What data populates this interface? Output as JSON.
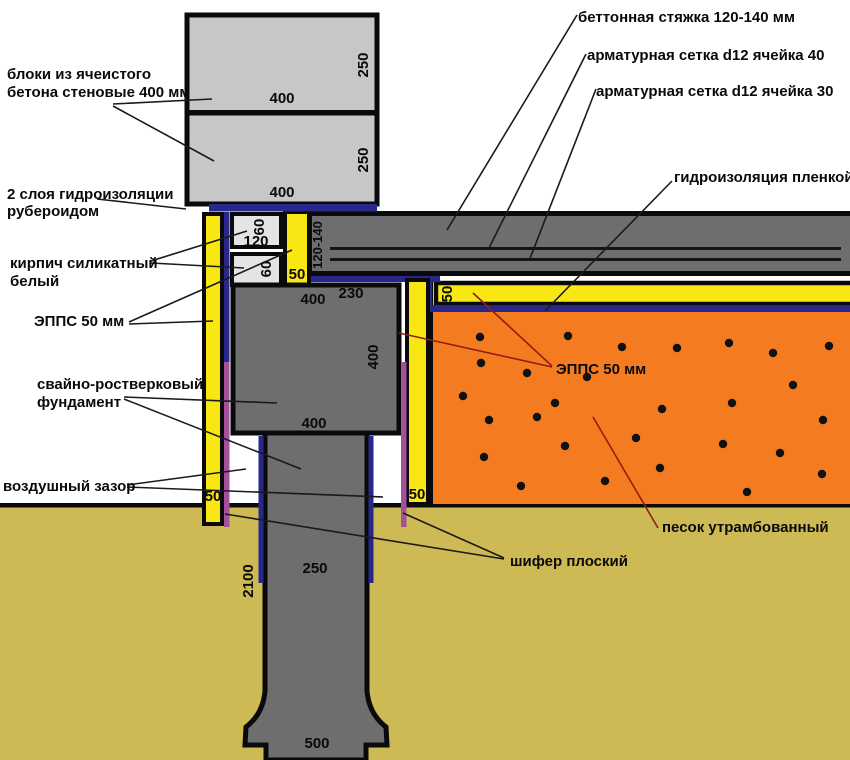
{
  "diagram_title": "Свайно-ростверковый фундамент (узел)",
  "ann": {
    "blocks": [
      "блоки из ячеистого",
      "бетона стеновые 400 мм"
    ],
    "waterproof_felt": [
      "2 слоя гидроизоляции",
      "рубероидом"
    ],
    "brick": [
      "кирпич силикатный",
      "белый"
    ],
    "eps_left": "ЭППС 50 мм",
    "foundation": [
      "свайно-ростверковый",
      "фундамент"
    ],
    "air_gap": "воздушный зазор",
    "screed": "беттонная стяжка 120-140 мм",
    "mesh40": "арматурная сетка d12 ячейка 40",
    "mesh30": "арматурная сетка d12 ячейка 30",
    "film": "гидроизоляция пленкой",
    "eps_sand": "ЭППС 50 мм",
    "sand": "песок утрамбованный",
    "slate": "шифер плоский"
  },
  "dims": {
    "block1_w": "400",
    "block1_h": "250",
    "block2_w": "400",
    "block2_h": "250",
    "brick1_w": "120",
    "brick1_h": "60",
    "brick2_h": "60",
    "eps_brick": "50",
    "screed_h": "120-140",
    "grillage_w_top": "400",
    "offset": "230",
    "grillage_h": "400",
    "grillage_w_bottom": "400",
    "eps_left": "50",
    "eps_right": "50",
    "eps_horiz": "50",
    "pile_depth": "2100",
    "pile_w": "250",
    "pile_bell_w": "500"
  },
  "colors": {
    "block_gray": "#C7C7C7",
    "concrete_gray": "#6E6E6E",
    "brick_light": "#E4E4E4",
    "insulation_yellow": "#F9E713",
    "membrane_navy": "#28288C",
    "slate_purple": "#A3509D",
    "sand_orange": "#F57B20",
    "soil_khaki": "#CDBA55",
    "leader_red": "#8E1F12",
    "outline_black": "#0A0A0A"
  },
  "sand_dots": [
    [
      480,
      337
    ],
    [
      568,
      336
    ],
    [
      622,
      347
    ],
    [
      677,
      348
    ],
    [
      729,
      343
    ],
    [
      773,
      353
    ],
    [
      829,
      346
    ],
    [
      481,
      363
    ],
    [
      527,
      373
    ],
    [
      587,
      377
    ],
    [
      463,
      396
    ],
    [
      537,
      417
    ],
    [
      555,
      403
    ],
    [
      662,
      409
    ],
    [
      732,
      403
    ],
    [
      793,
      385
    ],
    [
      823,
      420
    ],
    [
      489,
      420
    ],
    [
      565,
      446
    ],
    [
      636,
      438
    ],
    [
      723,
      444
    ],
    [
      780,
      453
    ],
    [
      484,
      457
    ],
    [
      605,
      481
    ],
    [
      521,
      486
    ],
    [
      660,
      468
    ],
    [
      747,
      492
    ],
    [
      822,
      474
    ]
  ]
}
